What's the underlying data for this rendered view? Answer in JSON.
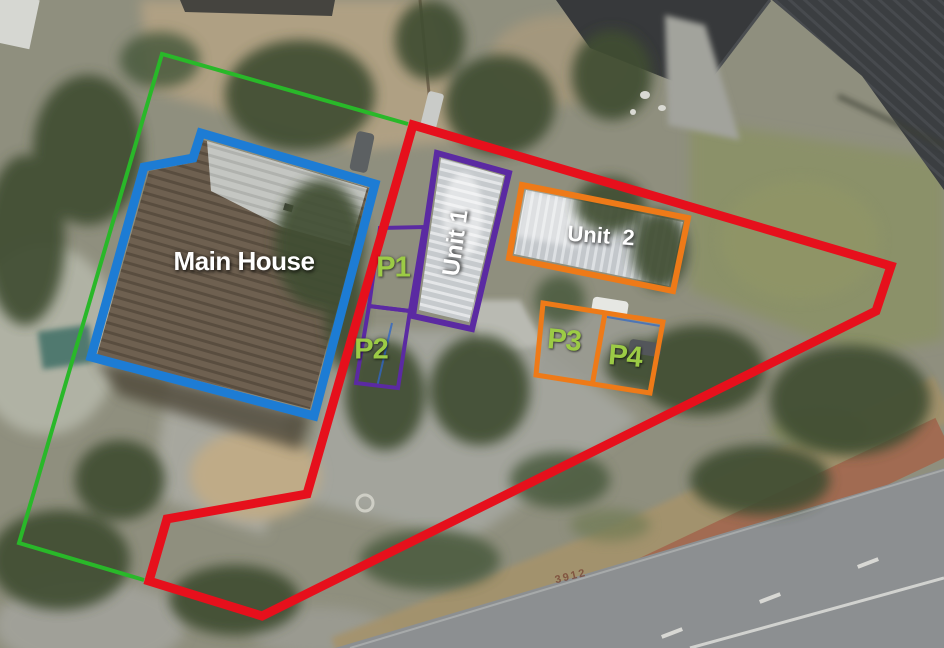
{
  "labels": {
    "main_house": "Main House",
    "unit_1": "Unit 1",
    "unit_2": "Unit  2",
    "p1": "P1",
    "p2": "P2",
    "p3": "P3",
    "p4": "P4",
    "road_marking": "3912"
  },
  "colors": {
    "boundary_green": "#29b829",
    "boundary_red": "#e6101c",
    "main_house_blue": "#1d7cd4",
    "unit_purple": "#5b2aa2",
    "unit_orange": "#ee7a18",
    "parking_label_green": "#9ccb45",
    "building_label_white": "#ffffff",
    "road_marking_brown": "#7a4636",
    "detail_blue": "#2f66c4"
  }
}
